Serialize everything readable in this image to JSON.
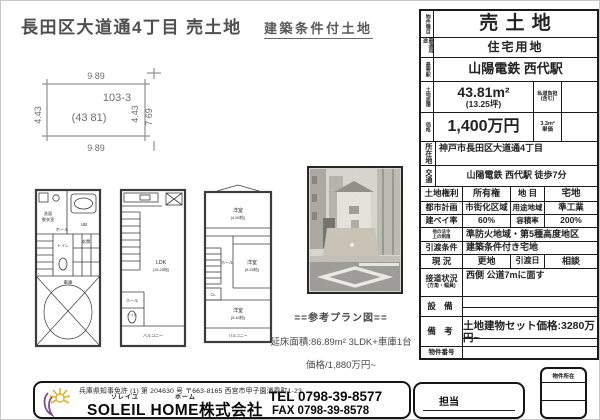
{
  "header": {
    "title": "長田区大道通4丁目 売土地",
    "condition": "建築条件付土地"
  },
  "lot_diagram": {
    "top": "9 89",
    "bottom": "9 89",
    "left": "4.43",
    "right": "4.43",
    "right_total": "7 69",
    "parcel": "103-3",
    "area": "(43 81)"
  },
  "floor_plans": {
    "f1": {
      "washroom1": "洗面",
      "washroom2": "脱衣室",
      "bath": "UB",
      "hall": "ホール",
      "toilet": "トイレ",
      "entrance": "玄関",
      "garage": "車庫"
    },
    "f2": {
      "ldk": "LDK",
      "ldk_size": "(15.25帖)",
      "hall": "ホール",
      "toilet": "トイレ",
      "balcony": "バルコニー"
    },
    "f3": {
      "room1": "洋室",
      "room1_size": "(4.50帖)",
      "room2": "洋室",
      "room2_size": "(5.25帖)",
      "room3": "洋室",
      "room3_size": "(5.40帖)",
      "hall": "ホール",
      "closet": "CL",
      "balcony": "バルコニー"
    }
  },
  "plan_note": {
    "heading": "==参考プラン図==",
    "area_line": "延床面積:86.89m² 3LDK+車庫1台",
    "price_line": "価格/1,880万円~"
  },
  "spec_table": {
    "type_label": "物件種目",
    "type_value": "売 土 地",
    "use_label": "最適用途",
    "use_value": "住宅用地",
    "station_label": "最寄駅",
    "station_value": "山陽電鉄 西代駅",
    "area_label": "土地面積",
    "area_value": "43.81m²",
    "area_tsubo": "(13.25坪)",
    "shido_label1": "私道負担",
    "shido_label2": "(含む)",
    "price_label": "価格",
    "price_value": "1,400万円",
    "unit_label1": "3.3m²",
    "unit_label2": "単価",
    "address_label": "所在地",
    "address_value": "神戸市長田区大道通4丁目",
    "access_label": "交通",
    "access_value": "山陽電鉄 西代駅 徒歩7分",
    "rights_label": "土地権利",
    "rights_value": "所有権",
    "mokuteki_label": "地 目",
    "mokuteki_value": "宅地",
    "cityplan_label": "都市計画",
    "cityplan_value": "市街化区域",
    "yoto_label": "用途地域",
    "yoto_value": "準工業",
    "kenpei_label": "建ペイ率",
    "kenpei_value": "60%",
    "yoseki_label": "容積率",
    "yoseki_value": "200%",
    "laws_label1": "他の法令",
    "laws_label2": "上の制限",
    "laws_value": "準防火地域・第5種高度地区",
    "cond_label": "引渡条件",
    "cond_value": "建築条件付き宅地",
    "genkyo_label": "現 況",
    "genkyo_value": "更地",
    "hikiwatashi_label": "引渡日",
    "hikiwatashi_value": "相談",
    "setsudo_label": "接道状況",
    "setsudo_sub": "(方角・幅員)",
    "setsudo_value": "西側 公道7mに面す",
    "setsubi_label": "設 備",
    "biko_label": "備 考",
    "biko_value": "土地建物セット価格:3280万円~",
    "bukken_label": "物件番号"
  },
  "footer": {
    "license": "兵庫県知事免許 (1) 第 204630 号 〒663-8165 西宮市甲子園浦風町1-23",
    "furigana_soleil": "ソレイユ",
    "furigana_home": "ホーム",
    "company": "SOLEIL HOME株式会社",
    "tel": "TEL 0798-39-8577",
    "fax": "FAX 0798-39-8578",
    "staff": "担当",
    "property_box": "物件所在"
  }
}
